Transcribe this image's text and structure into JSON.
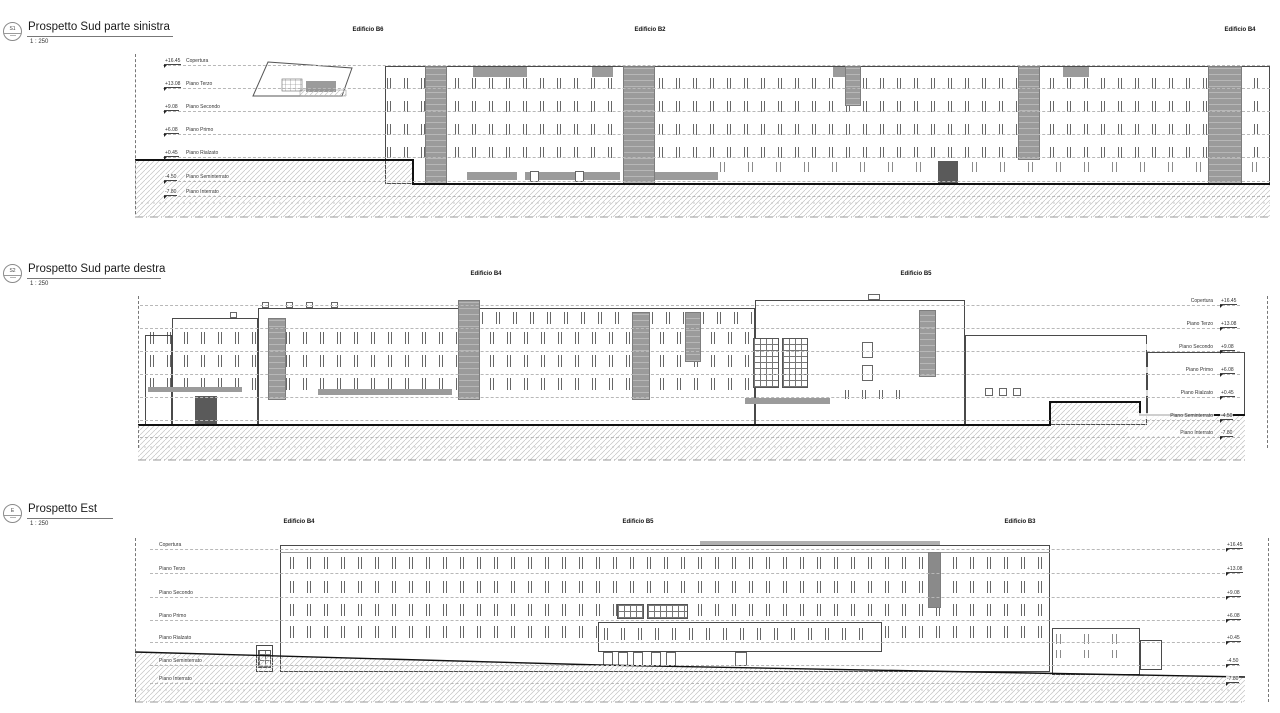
{
  "floors": [
    {
      "name": "Copertura",
      "value": "+16.45"
    },
    {
      "name": "Piano Terzo",
      "value": "+13.08"
    },
    {
      "name": "Piano Secondo",
      "value": "+9.08"
    },
    {
      "name": "Piano Primo",
      "value": "+6.08"
    },
    {
      "name": "Piano Rialzato",
      "value": "+0.45"
    },
    {
      "name": "Piano Seminterrato",
      "value": "-4.50"
    },
    {
      "name": "Piano Interrato",
      "value": "-7.80"
    }
  ],
  "panels": [
    {
      "marker": "S1",
      "title": "Prospetto Sud parte sinistra",
      "scale": "1 : 250",
      "buildings": [
        {
          "label": "Edificio B6"
        },
        {
          "label": "Edificio B2"
        },
        {
          "label": "Edificio B4"
        }
      ]
    },
    {
      "marker": "S2",
      "title": "Prospetto Sud parte destra",
      "scale": "1 : 250",
      "buildings": [
        {
          "label": "Edificio B4"
        },
        {
          "label": "Edificio B5"
        }
      ]
    },
    {
      "marker": "E",
      "title": "Prospetto Est",
      "scale": "1 : 250",
      "buildings": [
        {
          "label": "Edificio B4"
        },
        {
          "label": "Edificio B5"
        },
        {
          "label": "Edificio B3"
        }
      ]
    }
  ],
  "colors": {
    "core_gray": "#9b9b9b",
    "outline": "#4a4a4a",
    "hatch": "#c4c4c4",
    "ground_line": "#111111"
  }
}
